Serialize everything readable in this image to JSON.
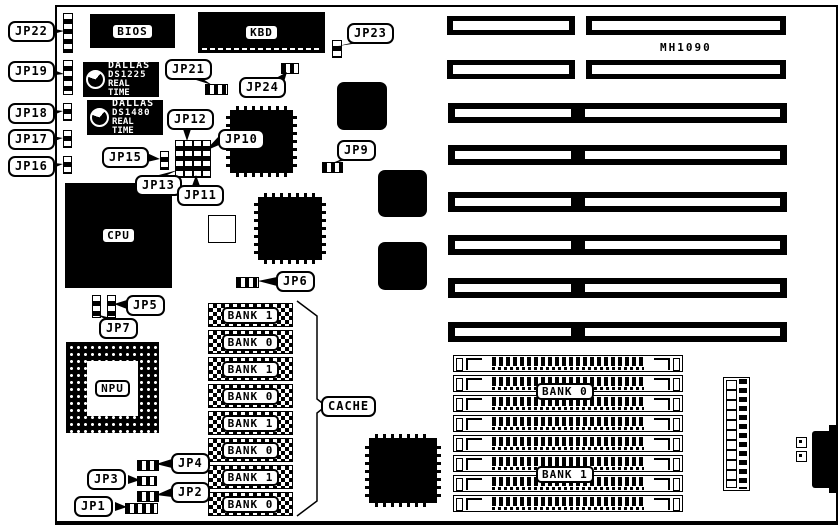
{
  "board": {
    "model": "MH1090"
  },
  "chips": {
    "bios": "BIOS",
    "kbd": "KBD",
    "cpu": "CPU",
    "npu": "NPU"
  },
  "rtc_chips": [
    {
      "brand": "DALLAS",
      "part": "DS1225",
      "type": "REAL TIME"
    },
    {
      "brand": "DALLAS",
      "part": "DS1480",
      "type": "REAL TIME"
    }
  ],
  "cache": {
    "label": "CACHE",
    "banks": [
      "BANK 1",
      "BANK 0",
      "BANK 1",
      "BANK 0",
      "BANK 1",
      "BANK 0",
      "BANK 1",
      "BANK 0"
    ]
  },
  "memory": {
    "bank0_label": "BANK 0",
    "bank1_label": "BANK 1"
  },
  "jumpers": {
    "jp1": "JP1",
    "jp2": "JP2",
    "jp3": "JP3",
    "jp4": "JP4",
    "jp5": "JP5",
    "jp6": "JP6",
    "jp7": "JP7",
    "jp9": "JP9",
    "jp10": "JP10",
    "jp11": "JP11",
    "jp12": "JP12",
    "jp13": "JP13",
    "jp15": "JP15",
    "jp16": "JP16",
    "jp17": "JP17",
    "jp18": "JP18",
    "jp19": "JP19",
    "jp21": "JP21",
    "jp22": "JP22",
    "jp23": "JP23",
    "jp24": "JP24"
  },
  "colors": {
    "ink": "#000000",
    "paper": "#ffffff"
  }
}
